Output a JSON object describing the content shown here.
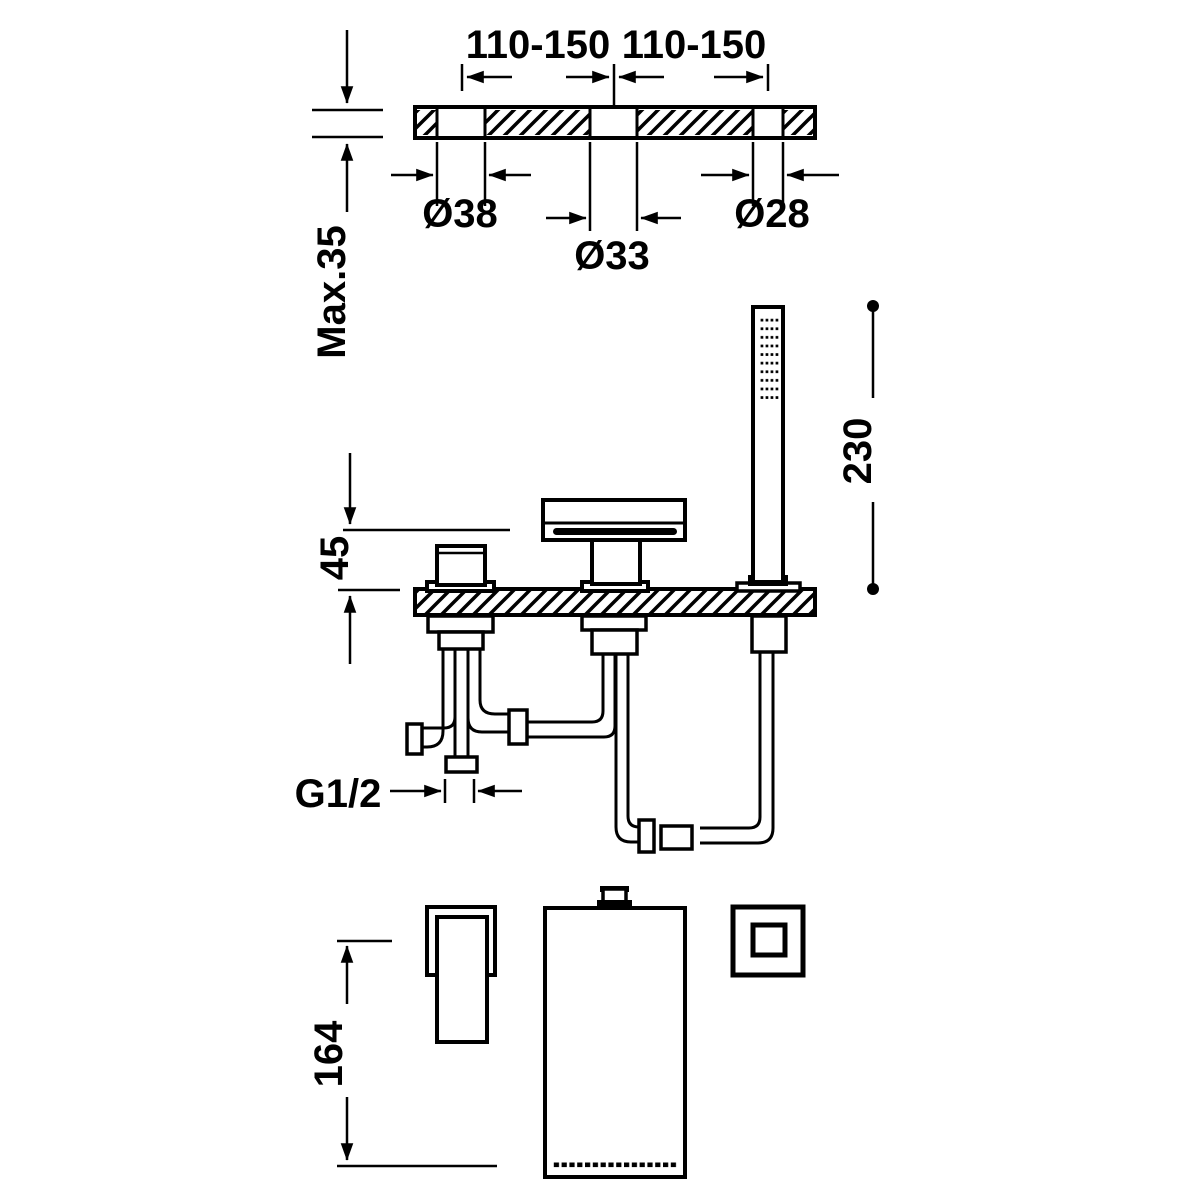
{
  "diagram": {
    "background": "#ffffff",
    "line_color": "#000000",
    "labels": {
      "span_left": "110-150",
      "span_right": "110-150",
      "dia_left": "Ø38",
      "dia_center": "Ø33",
      "dia_right": "Ø28",
      "max_depth": "Max.35",
      "spout_height": "45",
      "shower_height": "230",
      "thread_size": "G1/2",
      "handle_length": "164"
    }
  }
}
